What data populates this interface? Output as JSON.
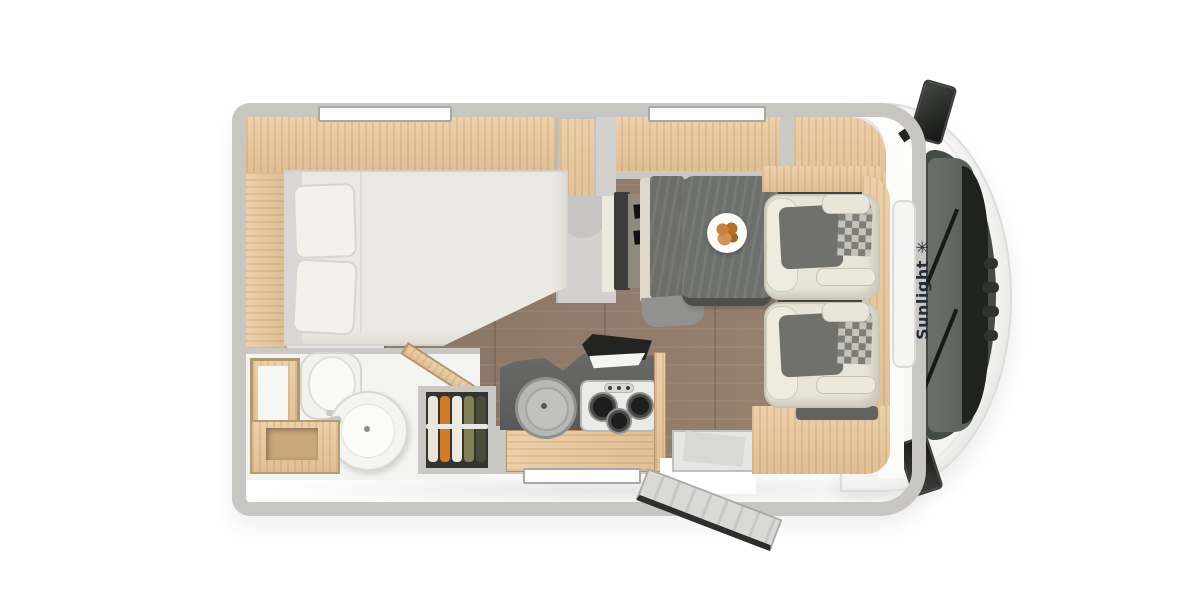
{
  "brand": {
    "label": "Sunlight",
    "logo_glyph": "✳"
  },
  "floorplan": {
    "view": "top-down",
    "vehicle": "motorhome",
    "rooms": [
      {
        "name": "rear-bed-area",
        "items": [
          "french-bed",
          "pillows",
          "overhead-cabinet",
          "side-shelf"
        ]
      },
      {
        "name": "bathroom",
        "items": [
          "toilet",
          "round-washbasin",
          "vanity-cabinet",
          "shower"
        ]
      },
      {
        "name": "wardrobe",
        "items": [
          "hanging-clothes",
          "clothes-rail"
        ]
      },
      {
        "name": "kitchen",
        "items": [
          "round-sink",
          "three-burner-hob",
          "worktop",
          "base-cabinet",
          "open-hob-lid"
        ]
      },
      {
        "name": "dinette",
        "items": [
          "table",
          "plate-of-food",
          "bench-seat",
          "tv-panel"
        ]
      },
      {
        "name": "cab",
        "items": [
          "driver-seat",
          "passenger-seat",
          "windshield",
          "side-mirror-left",
          "side-mirror-right",
          "roof-hatch"
        ]
      },
      {
        "name": "entrance",
        "items": [
          "entry-door-open",
          "entry-step"
        ]
      }
    ],
    "windows": [
      "rear-top-window",
      "dinette-top-window",
      "kitchen-bottom-window"
    ]
  },
  "colors": {
    "background": "#ffffff",
    "wall_gray": "#c7c6c3",
    "cabinet_wood": "#e6c89f",
    "floor_brown": "#8f7969",
    "worktop_dark": "#60615f",
    "seat_cream": "#e8e5d8",
    "seat_gray": "#70716b",
    "windshield": "#454c47",
    "brand_text": "#262b35"
  }
}
